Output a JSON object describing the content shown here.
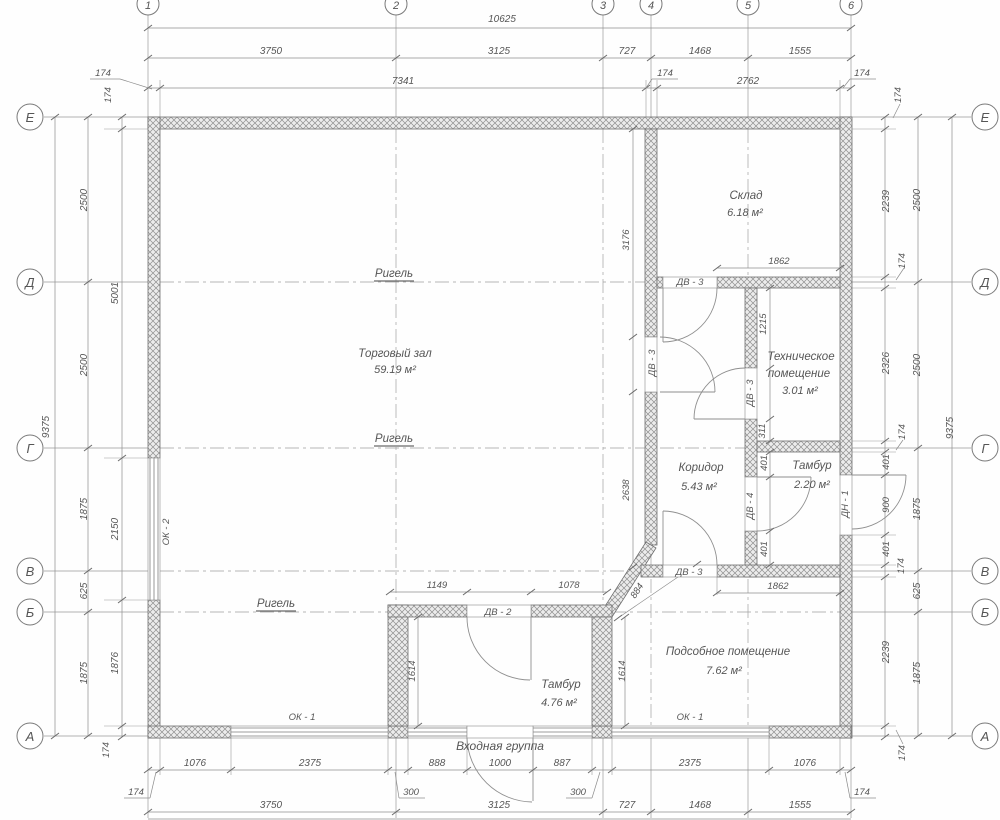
{
  "ax": {
    "t": [
      "1",
      "2",
      "3",
      "4",
      "5",
      "6"
    ],
    "s": [
      "Е",
      "Д",
      "Г",
      "В",
      "Б",
      "А"
    ]
  },
  "rooms": {
    "trade_hall": {
      "name": "Торговый зал",
      "area": "59.19 м²"
    },
    "warehouse": {
      "name": "Склад",
      "area": "6.18 м²"
    },
    "technical": {
      "name1": "Техническое",
      "name2": "помещение",
      "area": "3.01 м²"
    },
    "corridor": {
      "name": "Коридор",
      "area": "5.43 м²"
    },
    "vestibule_small": {
      "name": "Тамбур",
      "area": "2.20 м²"
    },
    "utility": {
      "name": "Подсобное помещение",
      "area": "7.62 м²"
    },
    "vestibule_entry": {
      "name": "Тамбур",
      "area": "4.76 м²"
    }
  },
  "labels": {
    "beam": "Ригель",
    "entrance": "Входная группа",
    "window1": "ОК - 1",
    "window2": "ОК - 2",
    "door_dv2": "ДВ - 2",
    "door_dv3": "ДВ - 3",
    "door_dv4": "ДВ - 4",
    "door_dn1": "ДН - 1"
  },
  "dims": {
    "top": [
      "10625",
      "3750",
      "3125",
      "727",
      "1468",
      "1555",
      "174",
      "7341",
      "174",
      "2762",
      "174"
    ],
    "bottom": [
      "1076",
      "2375",
      "888",
      "1000",
      "887",
      "2375",
      "1076",
      "174",
      "300",
      "300",
      "174",
      "3750",
      "3125",
      "727",
      "1468",
      "1555"
    ],
    "left": [
      "9375",
      "2500",
      "2500",
      "1875",
      "625",
      "1875",
      "174",
      "5001",
      "2150",
      "1876",
      "174"
    ],
    "right": [
      "174",
      "2239",
      "174",
      "2326",
      "174",
      "401",
      "900",
      "401",
      "174",
      "2239",
      "174",
      "2500",
      "2500",
      "1875",
      "625",
      "1875",
      "9375"
    ],
    "inner": [
      "1862",
      "1215",
      "311",
      "3176",
      "2638",
      "401",
      "401",
      "1862",
      "884",
      "1149",
      "1078",
      "1614",
      "1614"
    ]
  }
}
